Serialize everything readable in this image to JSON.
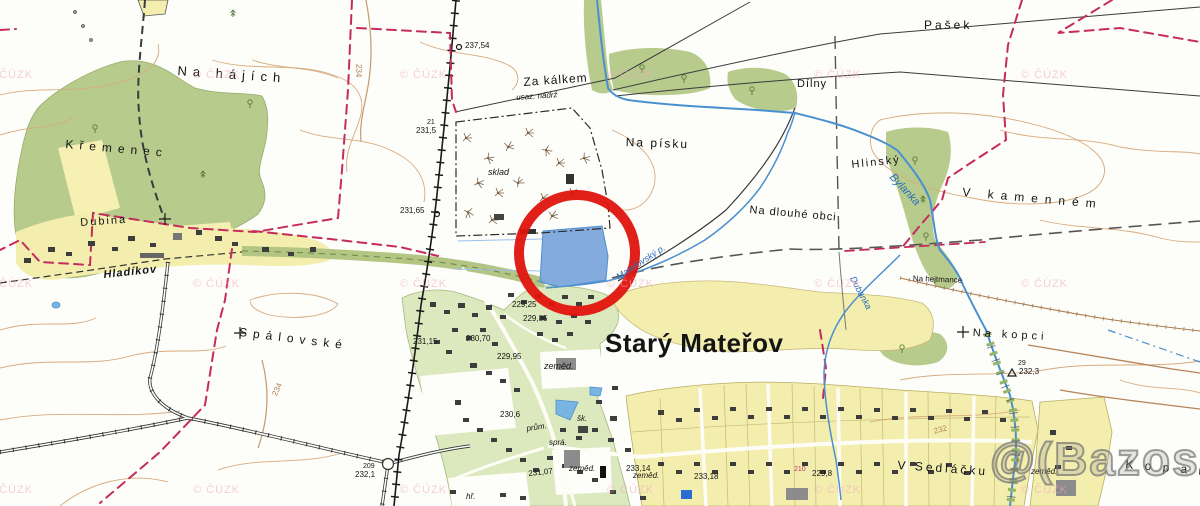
{
  "watermarks": {
    "cuzk": "© ČÚZK",
    "bazos": "@(Bazos.cz"
  },
  "annotation": {
    "shape": "red-circle",
    "color": "#e0140e"
  },
  "palette": {
    "forest_green": "#b7cb8d",
    "field_yellow": "#f3eeae",
    "village_green": "#dce8bd",
    "water_blue": "#4a90d0",
    "pond_fill": "#7aa4da",
    "boundary_pink": "#c62b5e",
    "contour_brown": "#d8ab7e",
    "red_circle": "#e0140e"
  },
  "places": [
    {
      "name": "na-hajich",
      "text": "Na hájích"
    },
    {
      "name": "kremenec",
      "text": "Křemenec"
    },
    {
      "name": "dubina",
      "text": "Dubina"
    },
    {
      "name": "hladikov",
      "text": "Hladíkov"
    },
    {
      "name": "spalovske",
      "text": "Spálovské"
    },
    {
      "name": "za-kalkem",
      "text": "Za kálkem"
    },
    {
      "name": "usaz-nadrz",
      "text": "usaz. nádrž"
    },
    {
      "name": "sklad",
      "text": "sklad"
    },
    {
      "name": "na-pisku",
      "text": "Na písku"
    },
    {
      "name": "dilny",
      "text": "Dílny"
    },
    {
      "name": "pasek",
      "text": "Pašek"
    },
    {
      "name": "hlinsky",
      "text": "Hlinský"
    },
    {
      "name": "v-kamennem",
      "text": "V kamenném"
    },
    {
      "name": "na-dlouhe-obci",
      "text": "Na dlouhé obci"
    },
    {
      "name": "na-hejtmance",
      "text": "Na hejtmance"
    },
    {
      "name": "na-kopci",
      "text": "Na kopci"
    },
    {
      "name": "v-sedlacku",
      "text": "V Sedláčku"
    },
    {
      "name": "kopan",
      "text": "K o p a n"
    },
    {
      "name": "stary-materov",
      "text": "Starý Mateřov"
    },
    {
      "name": "bylanka",
      "text": "Bylanka"
    },
    {
      "name": "dubanka",
      "text": "Dubanka"
    },
    {
      "name": "materovsky-potok",
      "text": "Mateřovský p."
    }
  ],
  "elevations": [
    "237,54",
    "21",
    "231,5",
    "231,65",
    "229,25",
    "229,85",
    "231,15",
    "230,70",
    "229,95",
    "230,6",
    "231,07",
    "233,14",
    "233,18",
    "229,8",
    "209",
    "232,1",
    "29",
    "232,3",
    "210"
  ],
  "abbreviations": [
    "zeměd.",
    "zeměd.",
    "zeměd.",
    "zeměd.",
    "šk.",
    "prům.",
    "sprá.",
    "hř."
  ],
  "contour_labels": [
    "234",
    "234",
    "232"
  ]
}
